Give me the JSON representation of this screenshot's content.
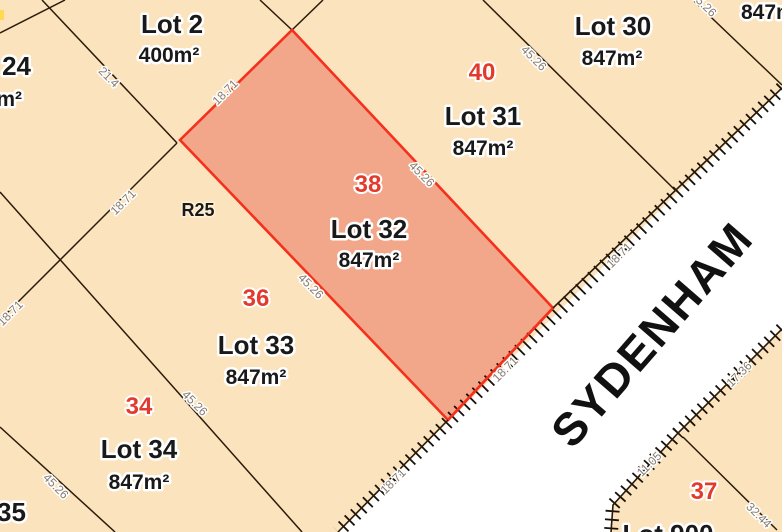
{
  "map_type": "cadastral-subdivision-plan",
  "road": {
    "name": "SYDENHAM"
  },
  "zoning": {
    "code": "R25"
  },
  "highlighted_lot": {
    "name": "Lot 32",
    "area": "847m²",
    "number": "38"
  },
  "lots": {
    "lot2": {
      "name": "Lot 2",
      "area": "400m²"
    },
    "lot30": {
      "name": "Lot 30",
      "area": "847m²"
    },
    "lot31": {
      "name": "Lot 31",
      "area": "847m²",
      "number": "40"
    },
    "lot32": {
      "name": "Lot 32",
      "area": "847m²",
      "number": "38"
    },
    "lot33": {
      "name": "Lot 33",
      "area": "847m²",
      "number": "36"
    },
    "lot34": {
      "name": "Lot 34",
      "area": "847m²",
      "number": "34"
    },
    "lot900": {
      "name": "Lot 900",
      "number": "37"
    },
    "edge_left": {
      "name_partial": "24",
      "area_partial": "m²"
    },
    "edge_bottom_left": {
      "name_partial": "35"
    },
    "edge_top_right": {
      "area_partial": "847m²"
    }
  },
  "dimensions": [
    {
      "text": "21.4"
    },
    {
      "text": "18.71"
    },
    {
      "text": "45.26"
    },
    {
      "text": "45.26"
    },
    {
      "text": "18.71"
    },
    {
      "text": "18.71"
    },
    {
      "text": "18.71"
    },
    {
      "text": "18.71"
    },
    {
      "text": "18.71"
    },
    {
      "text": "45.26"
    },
    {
      "text": "45.26"
    },
    {
      "text": "45.26"
    },
    {
      "text": "45.26"
    },
    {
      "text": "17.36"
    },
    {
      "text": "11.05"
    },
    {
      "text": "32.44"
    }
  ],
  "colors": {
    "parcel_fill": "#fbe3be",
    "highlight_fill": "#f2a78a",
    "highlight_stroke": "#f5301c",
    "boundary_line": "#2a1a08",
    "road_fill": "#ffffff",
    "lot_number_red": "#e23b2e",
    "dimension_gray": "#857b6f"
  }
}
